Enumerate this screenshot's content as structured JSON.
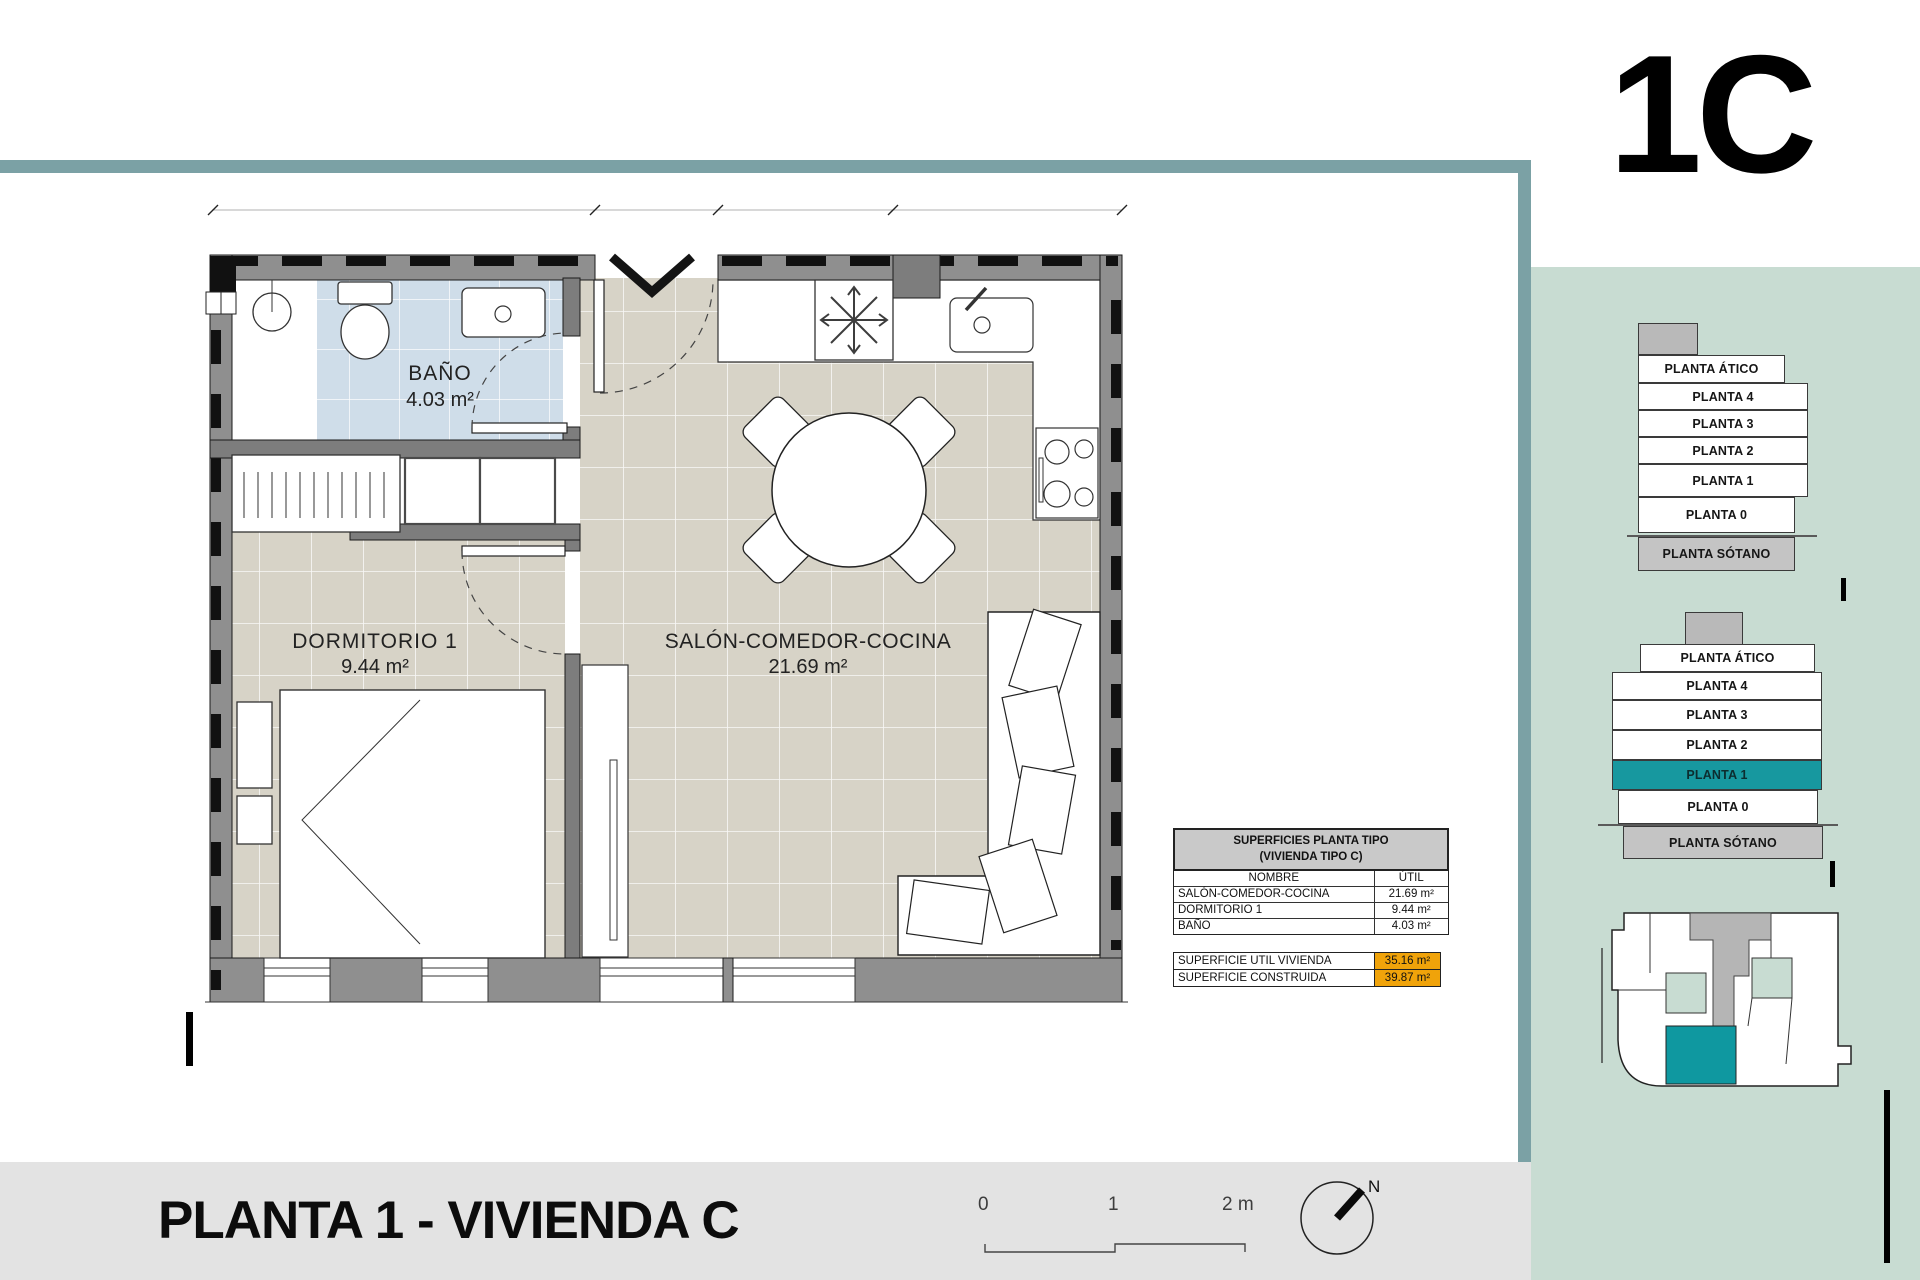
{
  "header": {
    "unit_code": "1C"
  },
  "plan": {
    "rooms": [
      {
        "name": "BAÑO",
        "area": "4.03 m²"
      },
      {
        "name": "DORMITORIO 1",
        "area": "9.44 m²"
      },
      {
        "name": "SALÓN-COMEDOR-COCINA",
        "area": "21.69 m²"
      }
    ]
  },
  "surfaces_table": {
    "title_line1": "SUPERFICIES PLANTA TIPO",
    "title_line2": "(VIVIENDA TIPO C)",
    "columns": {
      "name": "NOMBRE",
      "util": "ÚTIL"
    },
    "rows": [
      {
        "name": "SALÓN-COMEDOR-COCINA",
        "util": "21.69 m²"
      },
      {
        "name": "DORMITORIO 1",
        "util": "9.44 m²"
      },
      {
        "name": "BAÑO",
        "util": "4.03 m²"
      }
    ],
    "totals": [
      {
        "name": "SUPERFICIE UTIL VIVIENDA",
        "value": "35.16 m²"
      },
      {
        "name": "SUPERFICIE CONSTRUIDA",
        "value": "39.87 m²"
      }
    ]
  },
  "right_panel": {
    "stacks": [
      {
        "levels": [
          "PLANTA ÁTICO",
          "PLANTA 4",
          "PLANTA 3",
          "PLANTA 2",
          "PLANTA 1",
          "PLANTA 0",
          "PLANTA SÓTANO"
        ]
      },
      {
        "levels": [
          "PLANTA ÁTICO",
          "PLANTA 4",
          "PLANTA 3",
          "PLANTA 2",
          "PLANTA 1",
          "PLANTA 0",
          "PLANTA SÓTANO"
        ],
        "highlighted_level": "PLANTA 1"
      }
    ]
  },
  "footer": {
    "title": "PLANTA 1 - VIVIENDA C",
    "scale_labels": [
      "0",
      "1",
      "2 m"
    ],
    "compass_north": "N"
  },
  "colors": {
    "frame_teal": "#7ba1a5",
    "panel_green": "#c8dcd2",
    "accent_teal": "#17989f",
    "highlight_orange": "#f0a30a",
    "floor_beige": "#d7d3c7",
    "bath_blue": "#cfdde9"
  }
}
